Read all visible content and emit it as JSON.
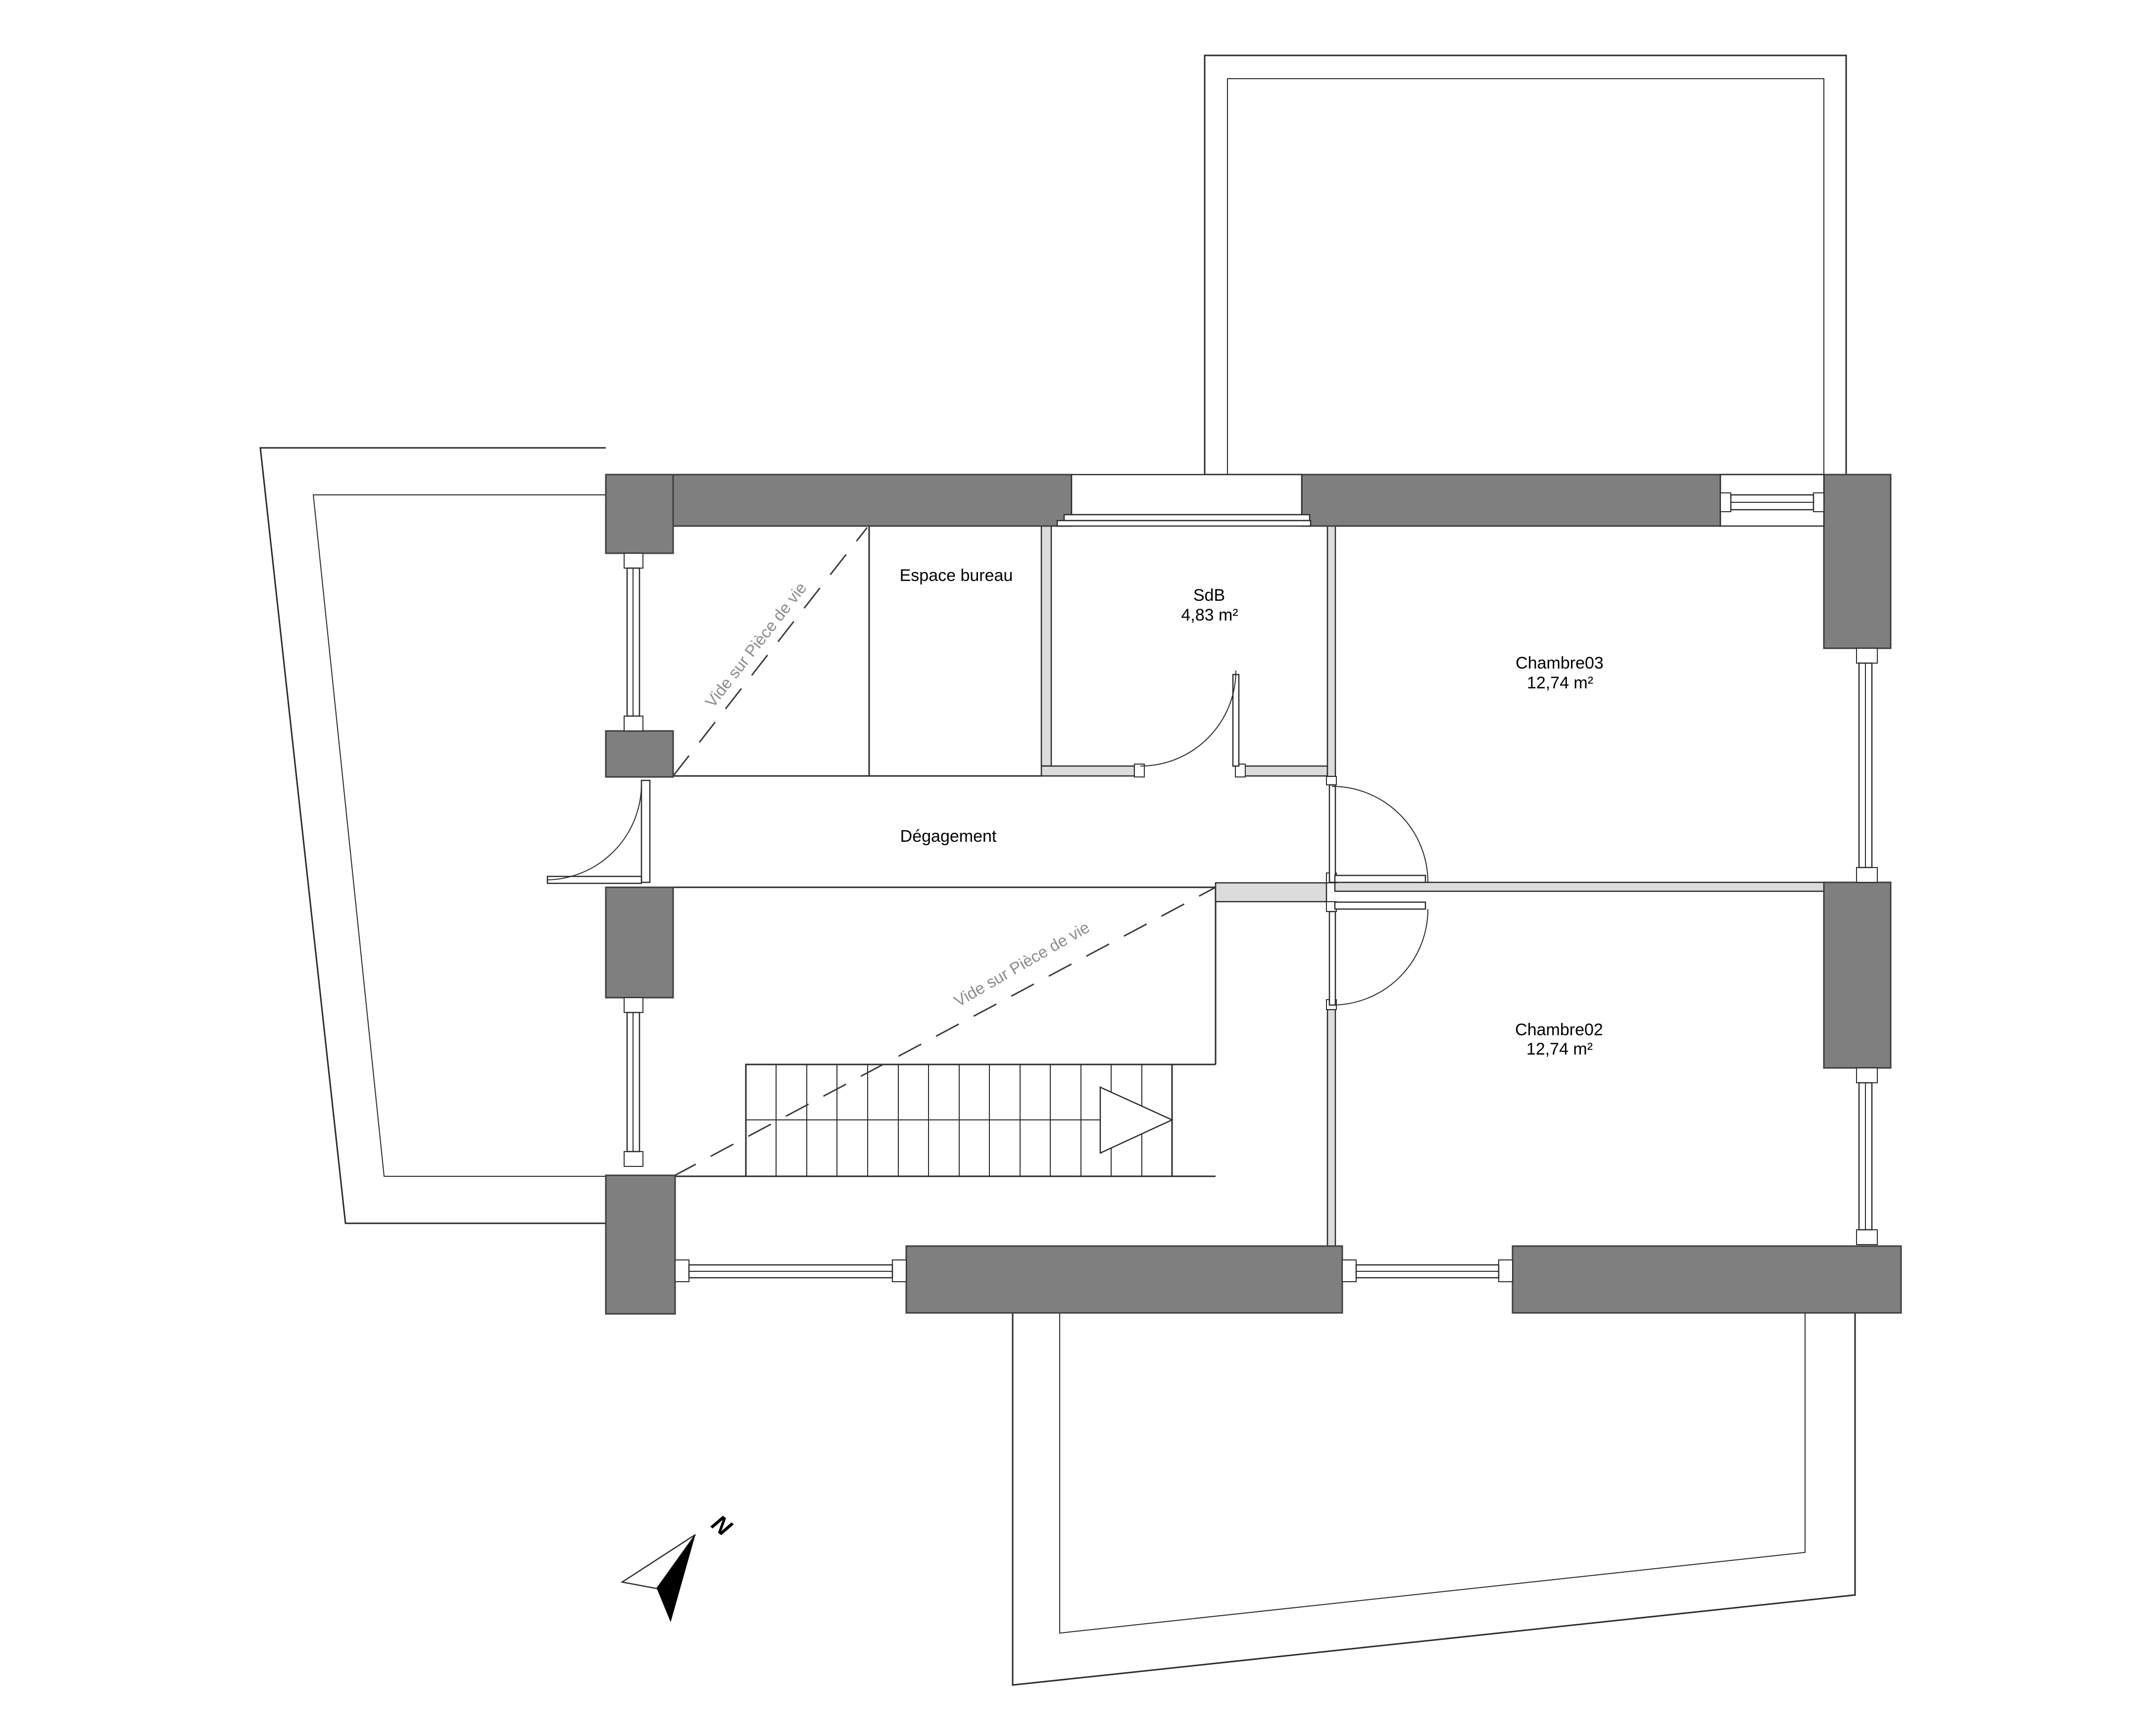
{
  "document": {
    "type": "floor-plan",
    "floor": "étage"
  },
  "rooms": {
    "espace_bureau": {
      "name": "Espace bureau"
    },
    "sdb": {
      "name": "SdB",
      "area": "4,83 m²"
    },
    "chambre03": {
      "name": "Chambre03",
      "area": "12,74 m²"
    },
    "degagement": {
      "name": "Dégagement"
    },
    "chambre02": {
      "name": "Chambre02",
      "area": "12,74 m²"
    }
  },
  "annotations": {
    "vide1": "Vide sur Pièce de vie",
    "vide2": "Vide sur Pièce de vie",
    "north": "N"
  },
  "colors": {
    "wall": "#7f7f7f",
    "wall_edge": "#3f3f3f",
    "partition": "#dcdcdc",
    "line": "#2b2b2b",
    "void_text": "#8c8c8c",
    "background": "#ffffff"
  }
}
